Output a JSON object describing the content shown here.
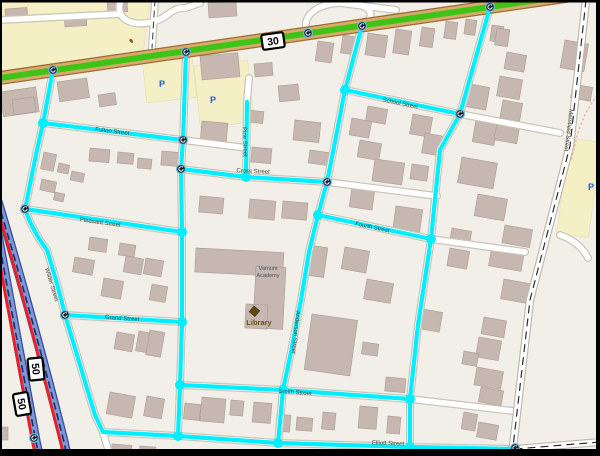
{
  "map": {
    "colors": {
      "route_highlight": "#00eeff",
      "road_highlight_green": "#3ec417",
      "road_highlight_red": "#ee1d23"
    },
    "shields": [
      {
        "label": "30"
      },
      {
        "label": "50"
      },
      {
        "label": "50"
      }
    ],
    "parking_symbol": "P",
    "streets": [
      {
        "name": "Fulton Street"
      },
      {
        "name": "Pleasant Street"
      },
      {
        "name": "Cross Street"
      },
      {
        "name": "School Street"
      },
      {
        "name": "Fourth Street"
      },
      {
        "name": "Grand Street"
      },
      {
        "name": "Smith Street"
      },
      {
        "name": "Elliott Street"
      },
      {
        "name": "Merrifield Street"
      },
      {
        "name": "Wilder Street"
      },
      {
        "name": "Pine Street"
      },
      {
        "name": "Anderson Street"
      }
    ],
    "pois": {
      "academy_line1": "Varnum",
      "academy_line2": "Academy",
      "library": "Library"
    }
  }
}
